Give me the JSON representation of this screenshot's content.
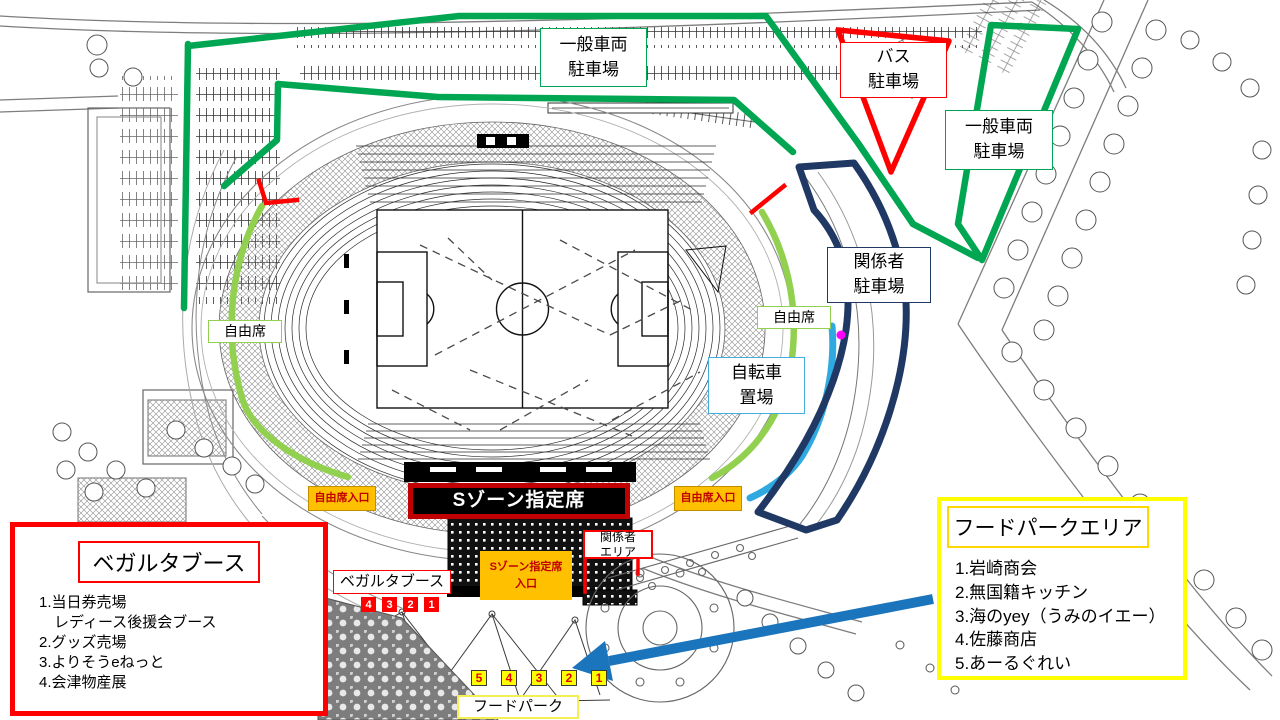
{
  "map": {
    "labels": {
      "parking_general_top": {
        "line1": "一般車両",
        "line2": "駐車場"
      },
      "parking_bus": {
        "line1": "バス",
        "line2": "駐車場"
      },
      "parking_general_right": {
        "line1": "一般車両",
        "line2": "駐車場"
      },
      "parking_staff": {
        "line1": "関係者",
        "line2": "駐車場"
      },
      "free_seat_left": "自由席",
      "free_seat_right": "自由席",
      "bicycle": {
        "line1": "自転車",
        "line2": "置場"
      },
      "free_seat_entrance_left": "自由席入口",
      "free_seat_entrance_right": "自由席入口",
      "s_zone": "Sゾーン指定席",
      "staff_area": {
        "line1": "関係者",
        "line2": "エリア"
      },
      "s_zone_entrance": {
        "line1": "Sゾーン指定席",
        "line2": "入口"
      },
      "vegalta_booth_small": "ベガルタブース",
      "food_park": "フードパーク"
    },
    "booth_numbers": [
      "4",
      "3",
      "2",
      "1"
    ],
    "foodpark_numbers": [
      "5",
      "4",
      "3",
      "2",
      "1"
    ]
  },
  "vegalta_panel": {
    "title": "ベガルタブース",
    "items": [
      "1.当日券売場",
      "　レディース後援会ブース",
      "2.グッズ売場",
      "3.よりそうeねっと",
      "4.会津物産展"
    ]
  },
  "foodpark_panel": {
    "title": "フードパークエリア",
    "items": [
      "1.岩崎商会",
      "2.無国籍キッチン",
      "3.海のyey（うみのイエー）",
      "4.佐藤商店",
      "5.あーるぐれい"
    ]
  },
  "colors": {
    "route_green": "#00A651",
    "free_seat_green": "#92D050",
    "staff_navy": "#1F3864",
    "bicycle_blue": "#2FA9E0",
    "gate_red": "#FF0000",
    "dark_red": "#C00000",
    "entrance_orange": "#FFC000",
    "foodpark_yellow": "#FFFF00",
    "arrow_blue": "#1B75BC",
    "dot_magenta": "#FF00FF"
  }
}
